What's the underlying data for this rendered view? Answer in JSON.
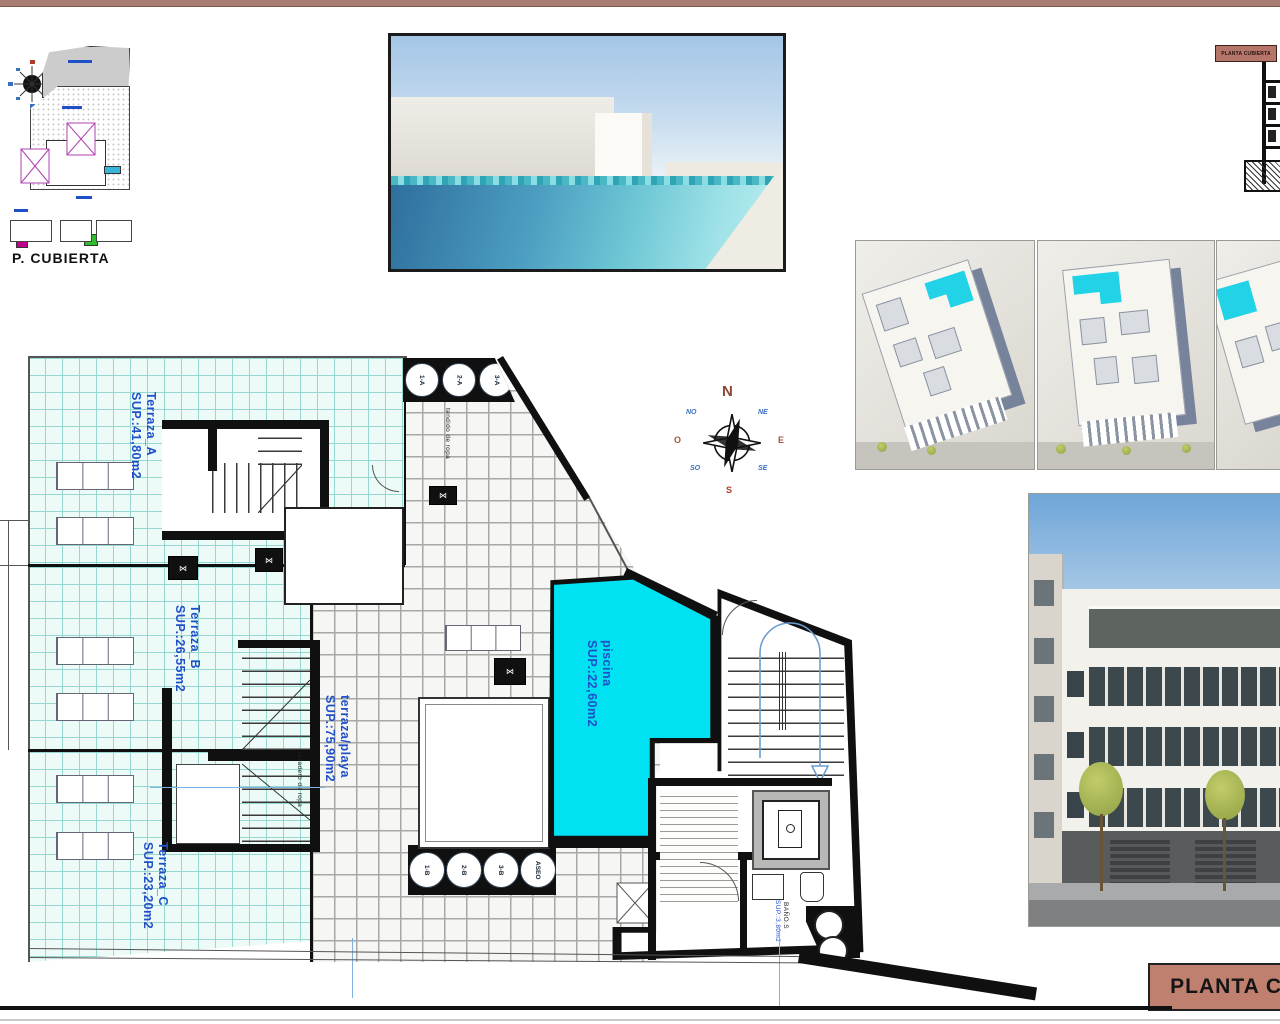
{
  "header": {
    "top_bar_color": "#a87c72"
  },
  "site_plan": {
    "title": "P. CUBIERTA"
  },
  "section_thumb": {
    "tag": "PLANTA CUBIERTA"
  },
  "compass": {
    "n": "N",
    "ne": "NE",
    "e": "E",
    "se": "SE",
    "s": "S",
    "so": "SO",
    "o": "O",
    "no": "NO"
  },
  "floor_plan": {
    "terraces": [
      {
        "name": "Terraza_A",
        "area": "SUP.:41,80m2"
      },
      {
        "name": "Terraza_B",
        "area": "SUP.:26,55m2"
      },
      {
        "name": "Terraza_C",
        "area": "SUP.:23,20m2"
      }
    ],
    "beach_terrace": {
      "name": "terraza/playa",
      "area": "SUP.:75,90m2"
    },
    "pool": {
      "name": "piscina",
      "area": "SUP.:22,60m2"
    },
    "clothesline_top": "tendido de ropa",
    "laundry": "lavadero de ropa",
    "ports_top": [
      "1-A",
      "2-A",
      "3-A"
    ],
    "ports_bottom": [
      "1-B",
      "2-B",
      "3-B",
      "ASEO"
    ],
    "bath": {
      "name": "BAÑO.S",
      "area": "SUP.:3,80m2"
    }
  },
  "title_block": {
    "label": "PLANTA C"
  },
  "colors": {
    "pool_water": "#00e1f2",
    "terrace_tile": "#ecfbf8",
    "label_blue": "#2050c8",
    "salmon": "#bc7b6d",
    "top_bar": "#a87c72"
  }
}
